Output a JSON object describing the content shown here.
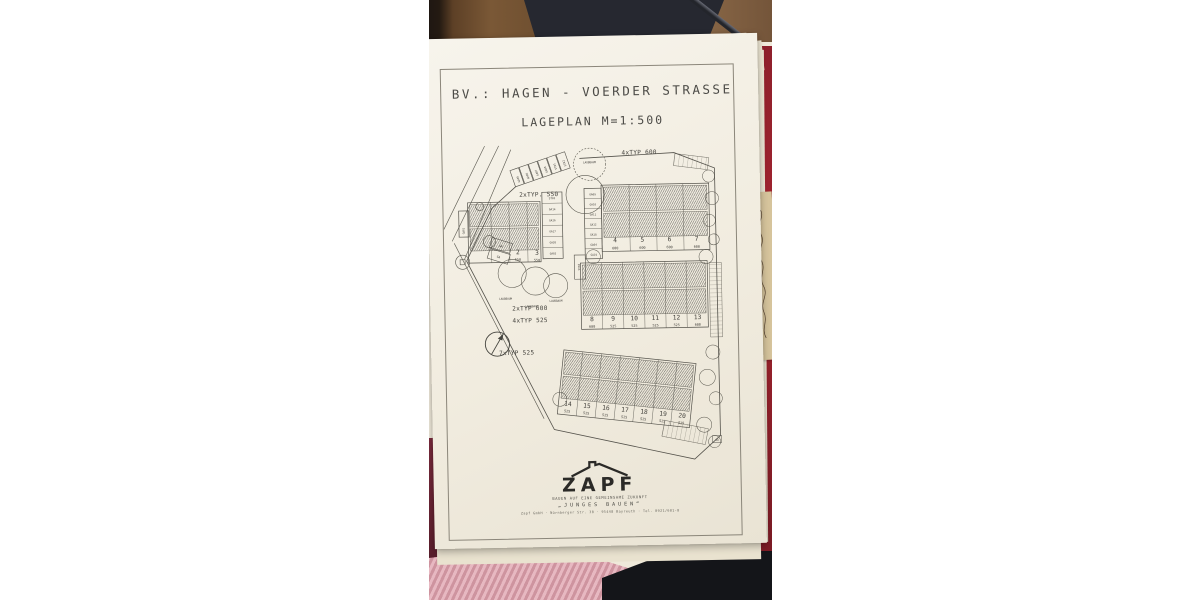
{
  "sheet": {
    "title1": "BV.: HAGEN - VOERDER STRASSE",
    "title2": "LAGEPLAN M=1:500"
  },
  "plan": {
    "labels": {
      "typ_top": "4xTYP 600",
      "typ_left": "2xTYP. 550",
      "typ_mid1": "2xTYP 600",
      "typ_mid2": "4xTYP 525",
      "typ_bottom": "7xTYP 525",
      "tree": "LAUBBAUM",
      "garage": "GA",
      "corner": "GA"
    },
    "diagonal_garages": [
      "GA05",
      "GA06",
      "GA07",
      "GA08",
      "ST01",
      "ST02"
    ],
    "left_garages": [
      "ST03",
      "GA14",
      "GA16",
      "GA17",
      "GA20",
      "GA03"
    ],
    "right_garages": [
      "GA09",
      "GA10",
      "GA11",
      "GA12",
      "GA18",
      "GA04",
      "GA19"
    ],
    "mid_garage": "ST04",
    "side_garage": "GA02",
    "houses": {
      "left": {
        "nums": [
          "2",
          "3"
        ],
        "sizes": [
          "550",
          "550"
        ]
      },
      "top": {
        "nums": [
          "4",
          "5",
          "6",
          "7"
        ],
        "sizes": [
          "600",
          "600",
          "600",
          "600"
        ]
      },
      "mid": {
        "nums": [
          "8",
          "9",
          "10",
          "11",
          "12",
          "13"
        ],
        "sizes": [
          "600",
          "525",
          "525",
          "525",
          "525",
          "600"
        ]
      },
      "bottom": {
        "nums": [
          "14",
          "15",
          "16",
          "17",
          "18",
          "19",
          "20"
        ],
        "sizes": [
          "525",
          "525",
          "525",
          "525",
          "525",
          "525",
          "525"
        ]
      }
    }
  },
  "logo": {
    "wordmark": "ZAPF",
    "tagline": "BAUEN AUF EINE GEMEINSAME ZUKUNFT",
    "subtitle": "„JUNGES BAUEN“",
    "address": "Zapf GmbH · Nürnberger Str. 38 · 95448 Bayreuth · Tel. 0921/601-0"
  },
  "colors": {
    "paper": "#f4f0e6",
    "ink": "#413f3a",
    "wood": "#7b5a3c",
    "fabric_dark": "#262830",
    "knit_pink": "#dfa0ac",
    "folder_red": "#9c2230",
    "kraft": "#d6c49c",
    "maroon": "#6e2535"
  }
}
